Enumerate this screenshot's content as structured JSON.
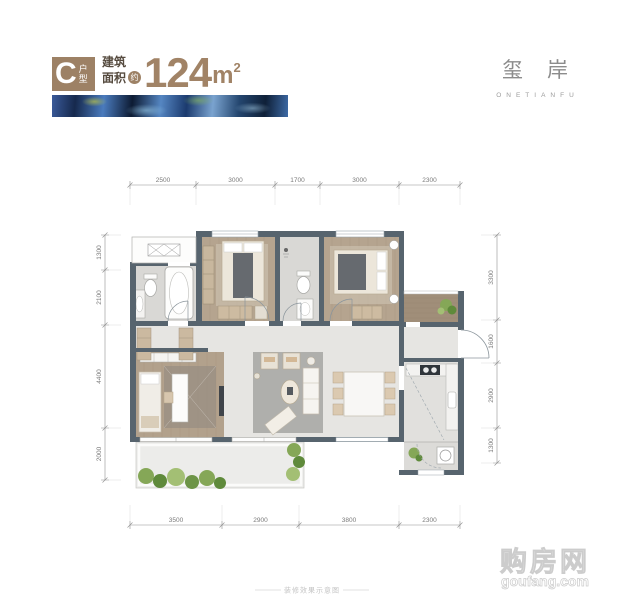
{
  "header": {
    "badge": {
      "letter": "C",
      "type_label": "户型"
    },
    "area": {
      "label_line1": "建筑",
      "label_line2": "面积",
      "approx_badge": "约",
      "value": "124",
      "unit": "m",
      "unit_sup": "2"
    },
    "brand": {
      "name": "玺岸",
      "subtitle": "ONETIANFU"
    }
  },
  "plan": {
    "dims": {
      "top": [
        "2500",
        "3000",
        "1700",
        "3000",
        "2300"
      ],
      "bottom": [
        "3500",
        "2900",
        "3800",
        "2300"
      ],
      "left": [
        "1300",
        "2100",
        "4400",
        "2000"
      ],
      "right": [
        "3300",
        "1600",
        "2900",
        "1300"
      ]
    }
  },
  "footer": {
    "caption": "装修效果示意图"
  },
  "watermark": {
    "title": "购房网",
    "domain": "goufang.com"
  },
  "colors": {
    "accent": "#9d8165",
    "wall": "#57646e",
    "wood": "#b5a48f",
    "tile": "#d9d8d5",
    "marble": "#e6e5e2",
    "plant_green": "#7ca254"
  }
}
